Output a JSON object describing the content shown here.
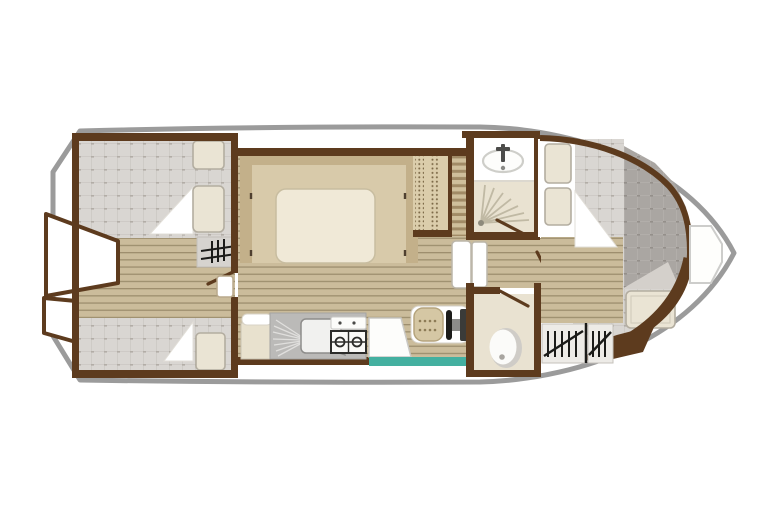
{
  "document": {
    "kind": "boat-floor-plan",
    "view": "top-down-deck-plan",
    "orientation": "stern-left-bow-right",
    "canvas": {
      "width": 768,
      "height": 512
    }
  },
  "palette": {
    "hull_outline": "#9b9b9b",
    "wall": "#5d3b1e",
    "plank": "#cbbc9b",
    "plank_line": "#8d7e5e",
    "deck": "#d9d6d2",
    "deck_line": "#c8c4bf",
    "deck_dot": "#b2ada6",
    "deck_dark": "#aaa6a2",
    "deck_dark_line": "#b7b3af",
    "bed_frame": "#c3b08a",
    "bed_inner": "#d8caaa",
    "mattress": "#f0e9d7",
    "cushion": "#eae4d4",
    "cushion_border": "#b3ada0",
    "cream": "#e9e2d1",
    "unit_gray": "#bbbab8",
    "teal": "#44b0a0",
    "seat": "#d5c7a4",
    "seat_dot": "#8d7c57",
    "icon_dark": "#1b1b19",
    "white": "#ffffff"
  },
  "areas": [
    {
      "id": "stern-platform",
      "floor": "white"
    },
    {
      "id": "aft-cabin",
      "floor": "checkered-deck"
    },
    {
      "id": "saloon",
      "floor": "wood-planks"
    },
    {
      "id": "galley",
      "floor": "wood-planks"
    },
    {
      "id": "helm-station",
      "floor": "wood-planks"
    },
    {
      "id": "shower-room",
      "floor": "cream"
    },
    {
      "id": "wc-room",
      "floor": "cream"
    },
    {
      "id": "corridor",
      "floor": "wood-planks"
    },
    {
      "id": "bow-cabin",
      "floor": "checkered-deck"
    },
    {
      "id": "bow-deck",
      "floor": "white"
    }
  ],
  "icons": [
    "companionway-steps-icon",
    "door-swing-icon",
    "door-leaf-icon",
    "berth-cushion-icon",
    "blanket-icon",
    "double-bed-icon",
    "wardrobe-icon",
    "shelf-steps-icon",
    "fridge-icon",
    "sink-icon",
    "faucet-icon",
    "gas-stove-icon",
    "counter-icon",
    "helm-seat-icon",
    "steering-wheel-icon",
    "instrument-panel-icon",
    "washbasin-icon",
    "shower-spray-icon",
    "toilet-icon",
    "ladder-hatch-icon",
    "bow-locker-icon"
  ]
}
